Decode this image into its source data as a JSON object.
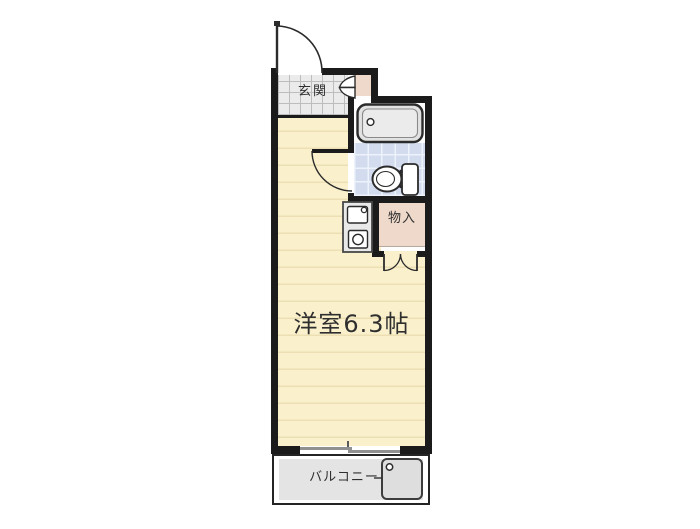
{
  "plan": {
    "labels": {
      "entrance": "玄関",
      "storage": "物入",
      "main_room": "洋室6.3帖",
      "balcony": "バルコニー"
    },
    "colors": {
      "wall": "#1b1b1b",
      "room_floor": "#faf0cc",
      "room_floor_line": "#ecdfb4",
      "entrance_tile": "#ebebeb",
      "entrance_tile_grid": "#bdbdbd",
      "bath_floor_tile": "#d3dcef",
      "bath_tile_grid": "#eef2fa",
      "closet_fill": "#eed9cb",
      "balcony_floor": "#e4e4e4",
      "fixture_gray": "#e2e2e2",
      "fixture_stroke": "#2b2b2b",
      "window_gray": "#909090",
      "text_color": "#2f2f2f"
    }
  }
}
